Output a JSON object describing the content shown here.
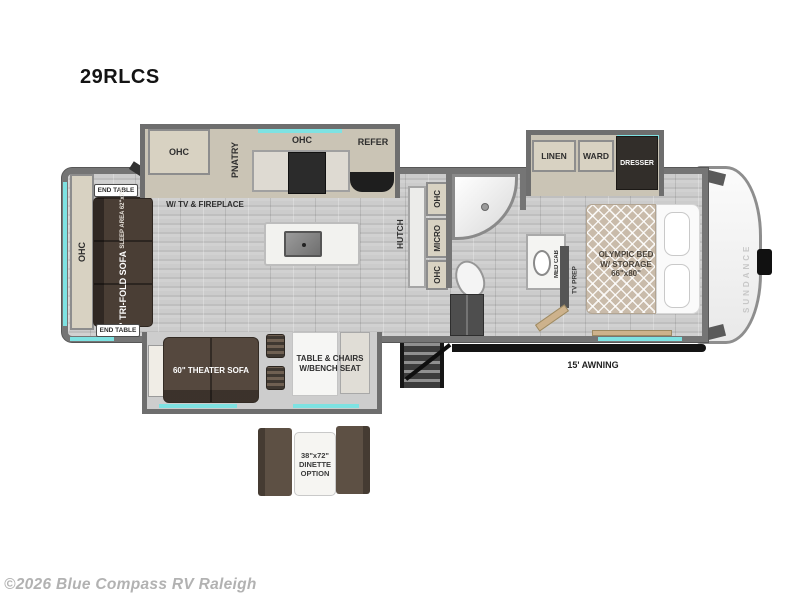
{
  "header": {
    "model": "29RLCS"
  },
  "footer": {
    "copyright": "©2026 Blue Compass RV Raleigh"
  },
  "exterior": {
    "brand": "SUNDANCE",
    "awning": "15' AWNING"
  },
  "colors": {
    "accent_cyan": "#7ee2e2",
    "wall_gray": "#757575",
    "cabinet_beige": "#d8d2c2",
    "sofa_brown": "#4a3e35",
    "floor_gray": "#c6c6c6"
  },
  "kitchen_slide": {
    "ohc_left": "OHC",
    "pantry": "PNATRY",
    "ohc_center": "OHC",
    "refer": "REFER"
  },
  "living": {
    "ohc_rear": "OHC",
    "end_table_top": "END TABLE",
    "end_table_bottom": "END TABLE",
    "sofa": "75\" TRI-FOLD SOFA",
    "sofa_sleep": "SLEEP AREA 62\"x75\"",
    "ent_center_l1": "ENT. CENTER",
    "ent_center_l2": "W/ TV & FIREPLACE"
  },
  "kitchen": {
    "hutch": "HUTCH",
    "ohc_upper": "OHC",
    "micro": "MICRO",
    "ohc_lower": "OHC"
  },
  "bath": {
    "med_cab": "MED CAB"
  },
  "bedroom_slide": {
    "linen": "LINEN",
    "ward": "WARD",
    "dresser": "DRESSER"
  },
  "bedroom": {
    "bed_l1": "OLYMPIC BED",
    "bed_l2": "W/ STORAGE",
    "bed_l3": "66\"x80\"",
    "tv_prep": "TV PREP"
  },
  "bottom_slide": {
    "theater_sofa": "60\" THEATER SOFA",
    "table_l1": "TABLE & CHAIRS",
    "table_l2": "W/BENCH SEAT"
  },
  "dinette_option": {
    "l1": "38\"x72\"",
    "l2": "DINETTE",
    "l3": "OPTION"
  }
}
